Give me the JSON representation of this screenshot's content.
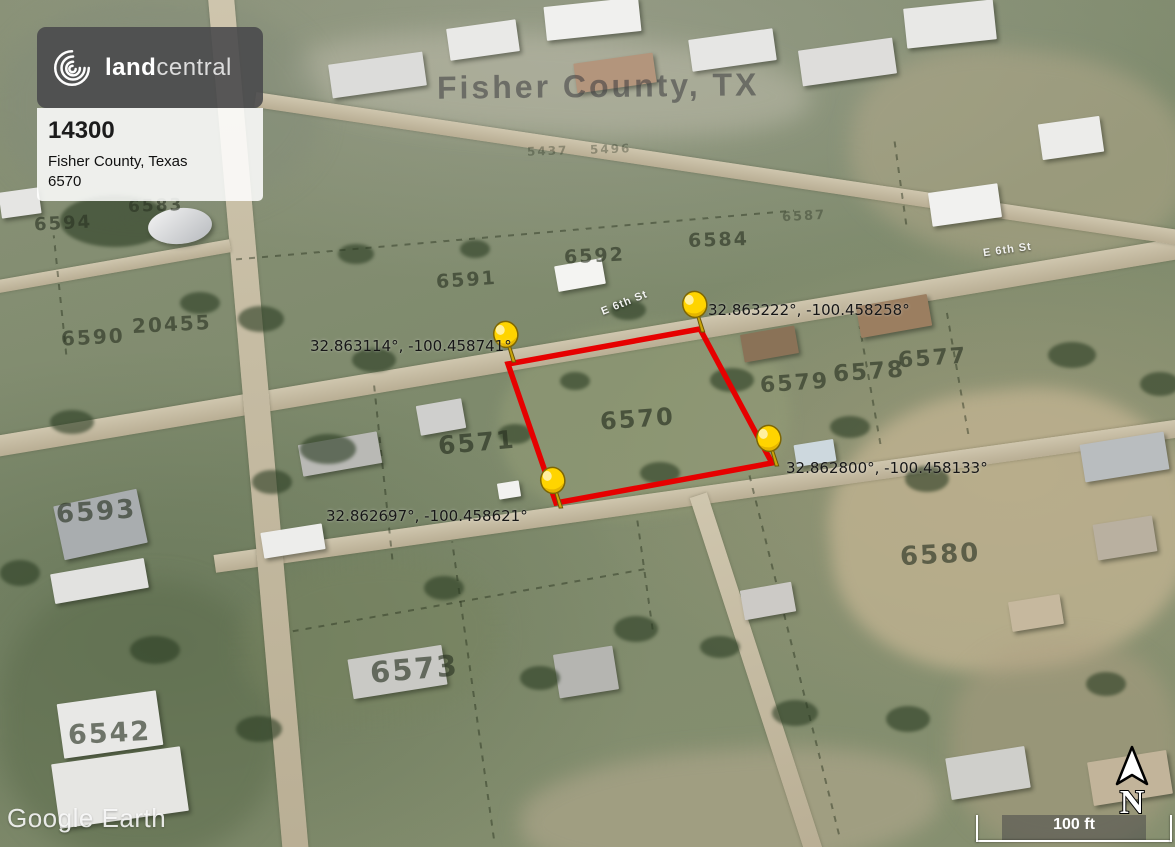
{
  "branding": {
    "logo_bold": "land",
    "logo_light": "central",
    "listing_id": "14300",
    "listing_location": "Fisher County, Texas",
    "listing_lot": "6570"
  },
  "watermarks": {
    "county_label": "Fisher County, TX",
    "imagery_credit": "Google Earth"
  },
  "map": {
    "pins": [
      {
        "label": "32.863222°, -100.458258°"
      },
      {
        "label": "32.863114°, -100.458741°"
      },
      {
        "label": "32.862800°, -100.458133°"
      },
      {
        "label": "32.862697°, -100.458621°"
      }
    ],
    "parcels": [
      {
        "label": "6583"
      },
      {
        "label": "6594"
      },
      {
        "label": "20455"
      },
      {
        "label": "6590"
      },
      {
        "label": "5437"
      },
      {
        "label": "5496"
      },
      {
        "label": "6587"
      },
      {
        "label": "6591"
      },
      {
        "label": "6592"
      },
      {
        "label": "6584"
      },
      {
        "label": "6577"
      },
      {
        "label": "6578"
      },
      {
        "label": "6579"
      },
      {
        "label": "6570"
      },
      {
        "label": "6571"
      },
      {
        "label": "6580"
      },
      {
        "label": "6573"
      },
      {
        "label": "6593"
      },
      {
        "label": "6542"
      }
    ],
    "streets": [
      {
        "label": "E 6th St"
      },
      {
        "label": "E 6th St"
      }
    ]
  },
  "controls": {
    "scale_label": "100 ft",
    "north_label": "N"
  },
  "colors": {
    "parcel_outline": "#e60000",
    "pin": "#ffd400",
    "brand_badge_bg": "#4a4a4c"
  }
}
